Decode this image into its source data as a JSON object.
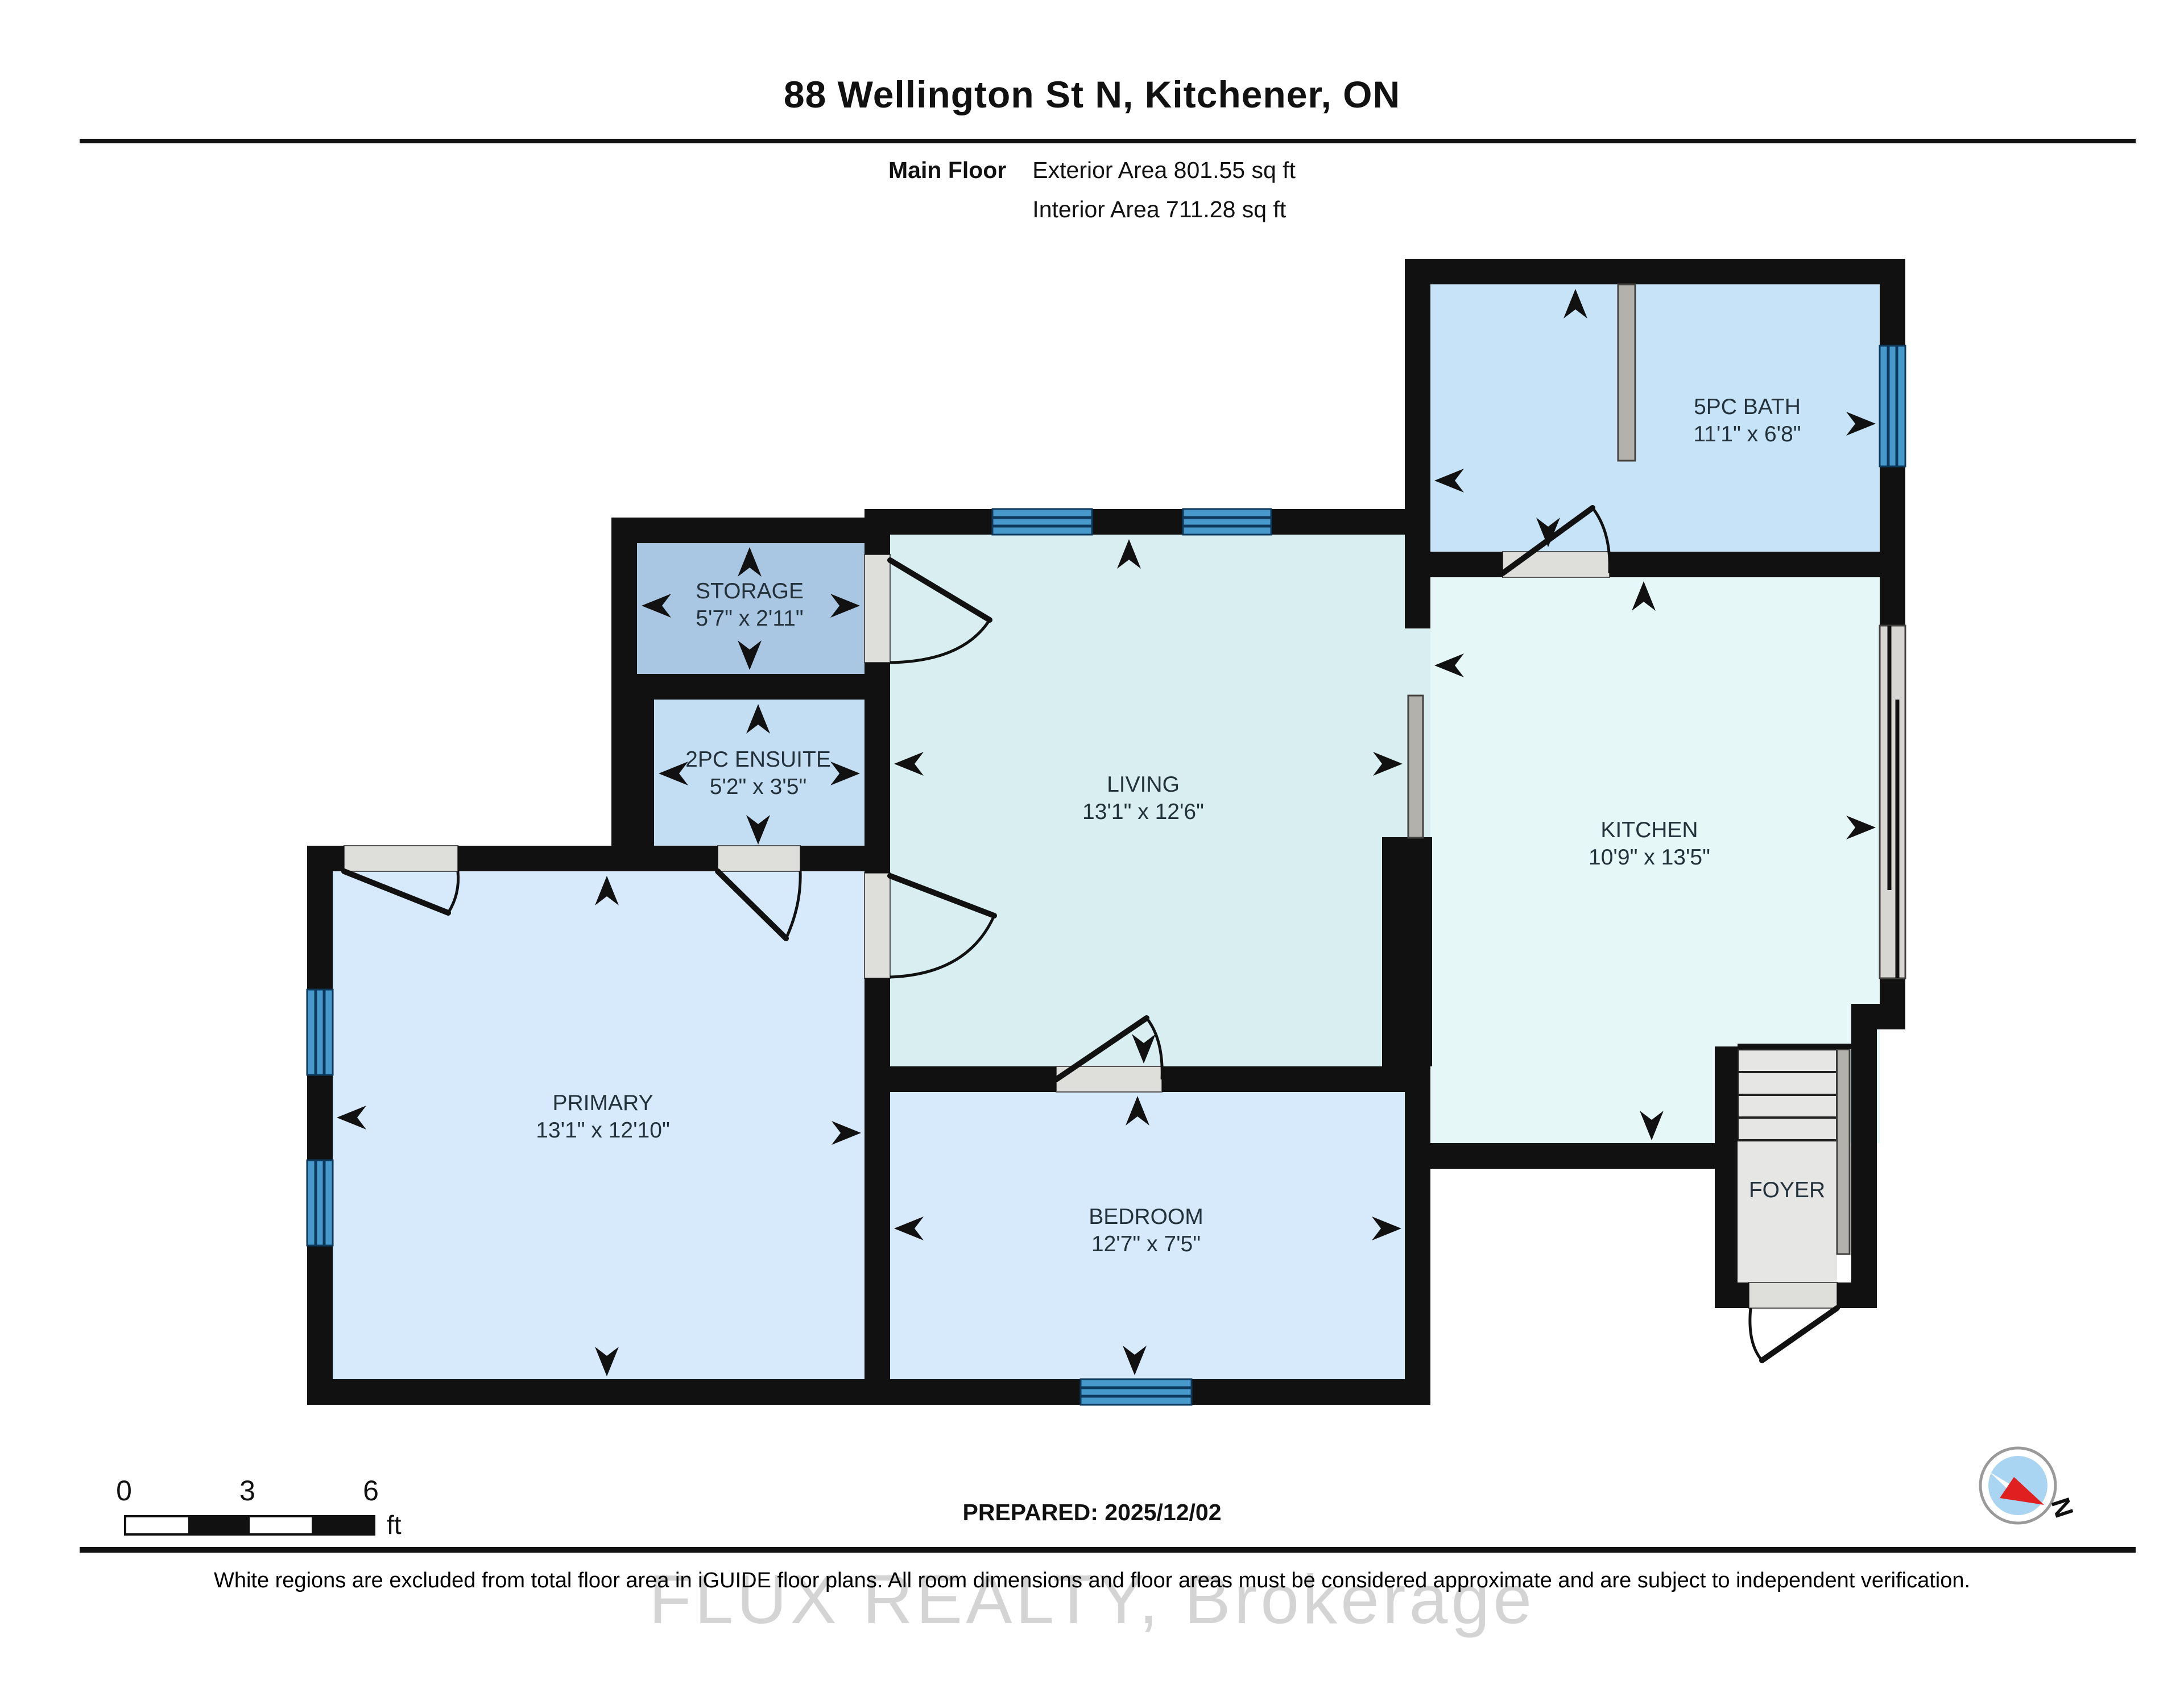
{
  "header": {
    "title": "88 Wellington St N, Kitchener, ON",
    "floor_label": "Main Floor",
    "exterior_area": "Exterior Area 801.55 sq ft",
    "interior_area": "Interior Area 711.28 sq ft"
  },
  "rooms": {
    "storage": {
      "name": "STORAGE",
      "dims": "5'7\" x 2'11\""
    },
    "ensuite": {
      "name": "2PC ENSUITE",
      "dims": "5'2\" x 3'5\""
    },
    "living": {
      "name": "LIVING",
      "dims": "13'1\" x 12'6\""
    },
    "kitchen": {
      "name": "KITCHEN",
      "dims": "10'9\" x 13'5\""
    },
    "bath": {
      "name": "5PC BATH",
      "dims": "11'1\" x 6'8\""
    },
    "primary": {
      "name": "PRIMARY",
      "dims": "13'1\" x 12'10\""
    },
    "bedroom": {
      "name": "BEDROOM",
      "dims": "12'7\" x 7'5\""
    },
    "foyer": {
      "name": "FOYER"
    }
  },
  "scale_bar": {
    "tick_0": "0",
    "tick_3": "3",
    "tick_6": "6",
    "unit": "ft"
  },
  "footer": {
    "prepared": "PREPARED: 2025/12/02",
    "disclaimer": "White regions are excluded from total floor area in iGUIDE floor plans. All room dimensions and floor areas must be considered approximate and are subject to independent verification.",
    "watermark": "FLUX REALTY, Brokerage",
    "compass_north": "N"
  },
  "colors": {
    "walls": "#111111",
    "living": "#d9eef0",
    "kitchen": "#e6f7f7",
    "bedroom_primary": "#d7eafc",
    "bath": "#c7e3f7",
    "ensuite": "#c3ddf3",
    "storage": "#a9c7e2",
    "window": "#4799cc",
    "compass_red": "#e02020"
  }
}
